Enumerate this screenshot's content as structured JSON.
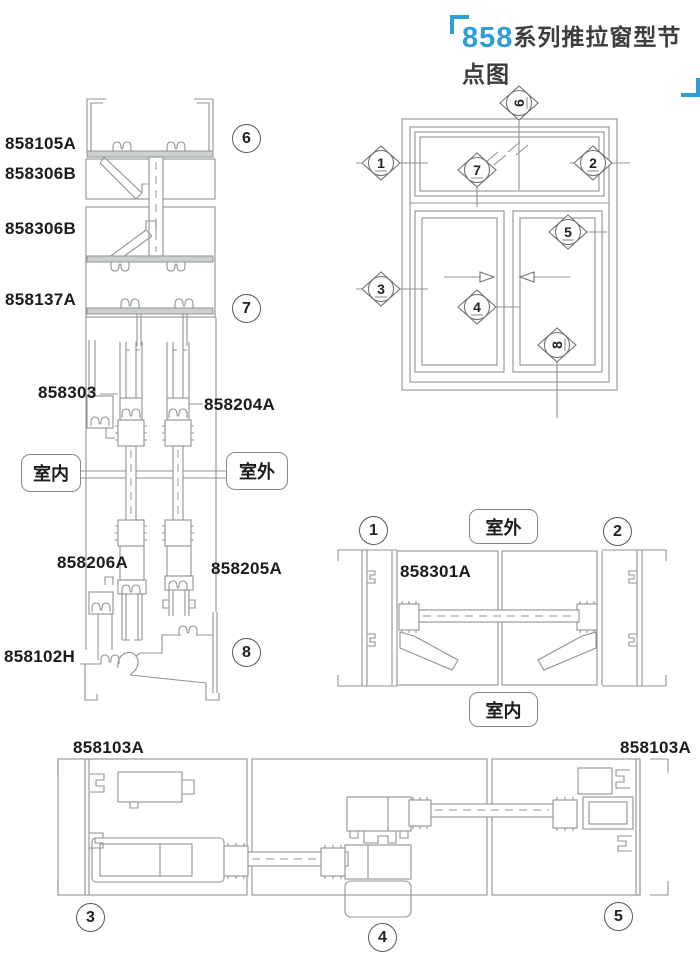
{
  "title": {
    "series": "858",
    "text": "系列推拉窗型节点图"
  },
  "colors": {
    "accent": "#2e9fd4",
    "line": "#8f9394",
    "text": "#1b1b1b"
  },
  "vertical_section": {
    "labels": {
      "top_frame": "858105A",
      "bead_upper": "858306B",
      "bead_lower": "858306B",
      "mid_frame": "858137A",
      "track": "858303",
      "rail": "858204A",
      "sash_left": "858206A",
      "sash_right": "858205A",
      "sill": "858102H"
    },
    "rooms": {
      "inside": "室内",
      "outside": "室外"
    },
    "details": {
      "c6": "6",
      "c7": "7",
      "c8": "8"
    }
  },
  "elevation": {
    "markers": {
      "m1": "1",
      "m2": "2",
      "m3": "3",
      "m4": "4",
      "m5": "5",
      "m6": "6",
      "m7": "7",
      "m8": "8"
    }
  },
  "horizontal_section": {
    "label": "858301A",
    "rooms": {
      "outside": "室外",
      "inside": "室内"
    },
    "details": {
      "c1": "1",
      "c2": "2"
    }
  },
  "bottom_section": {
    "label_left": "858103A",
    "label_right": "858103A",
    "details": {
      "c3": "3",
      "c4": "4",
      "c5": "5"
    }
  }
}
